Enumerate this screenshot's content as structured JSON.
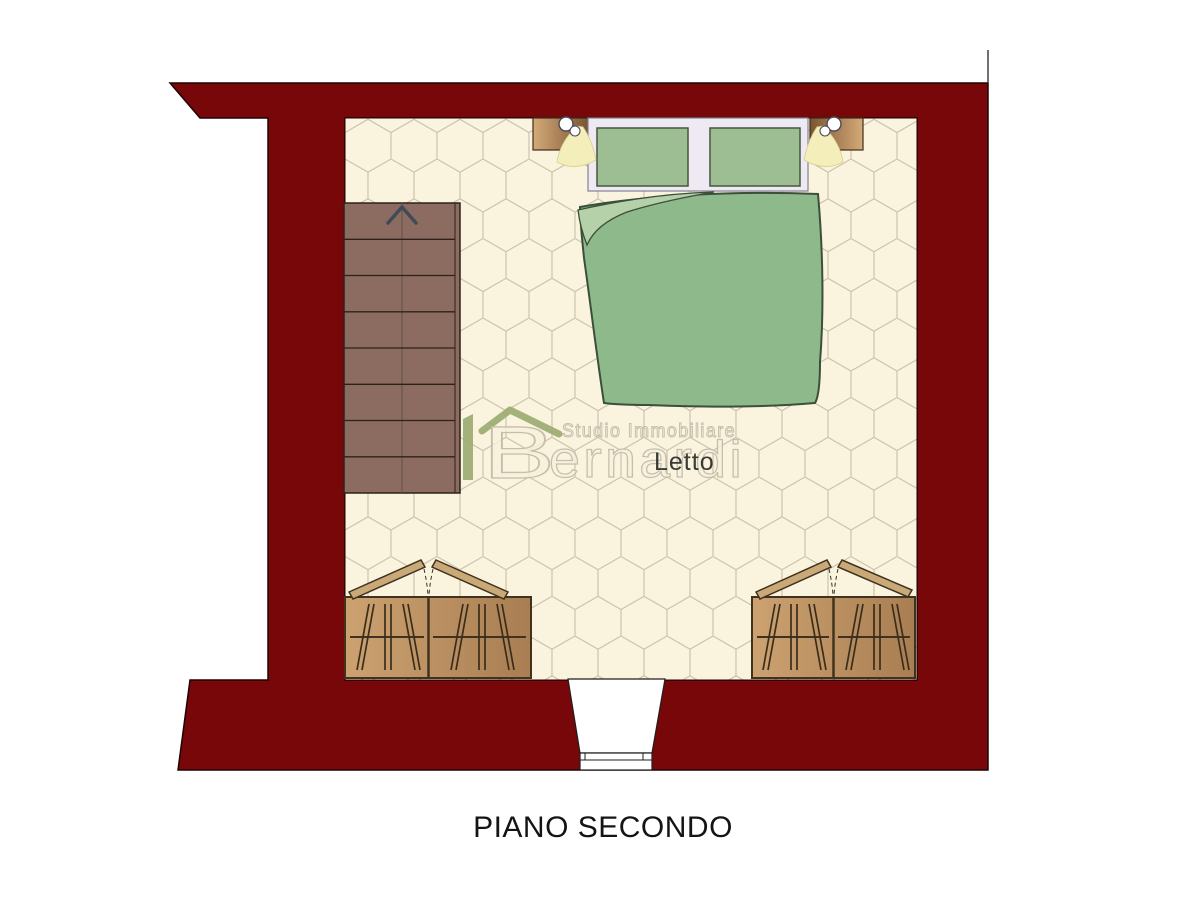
{
  "title": {
    "text": "PIANO SECONDO"
  },
  "room": {
    "label": "Letto"
  },
  "watermark": {
    "monogram": "B",
    "studio_line": "Studio Immobiliare",
    "brand": "ernardi"
  },
  "stairs": {
    "direction": "up",
    "treads": 8
  },
  "colors": {
    "wall": "#770708",
    "wall_outline": "#1f0404",
    "floor": "#faf3de",
    "tile_line": "#cdc4ad",
    "stair": "#8c6c60",
    "stair_line": "#2e211b",
    "bed_duvet": "#8eb98a",
    "bed_fold": "#b4d1aa",
    "bed_outline": "#3b4f3a",
    "pillow": "#9cbe92",
    "headboard": "#efe9f4",
    "wood_light": "#d4aa78",
    "wood_dark": "#7b5433",
    "wardrobe_light": "#cda271",
    "wardrobe_dark": "#a87e52",
    "wardrobe_line": "#41321f",
    "lamp_glow": "#f4eebb",
    "logo_green": "#9fae75",
    "watermark_fill": "#f7f1dc",
    "watermark_stroke": "#c3bcab",
    "label_text": "#3a3a38",
    "title_text": "#141414",
    "arrow": "#3f4b57"
  },
  "elements": [
    "exterior-walls",
    "hex-tile-floor",
    "staircase-up",
    "double-bed",
    "window-headboard",
    "nightstand-left",
    "nightstand-right",
    "wall-lamp-left",
    "wall-lamp-right",
    "wardrobe-left",
    "wardrobe-right",
    "door-opening-threshold"
  ]
}
